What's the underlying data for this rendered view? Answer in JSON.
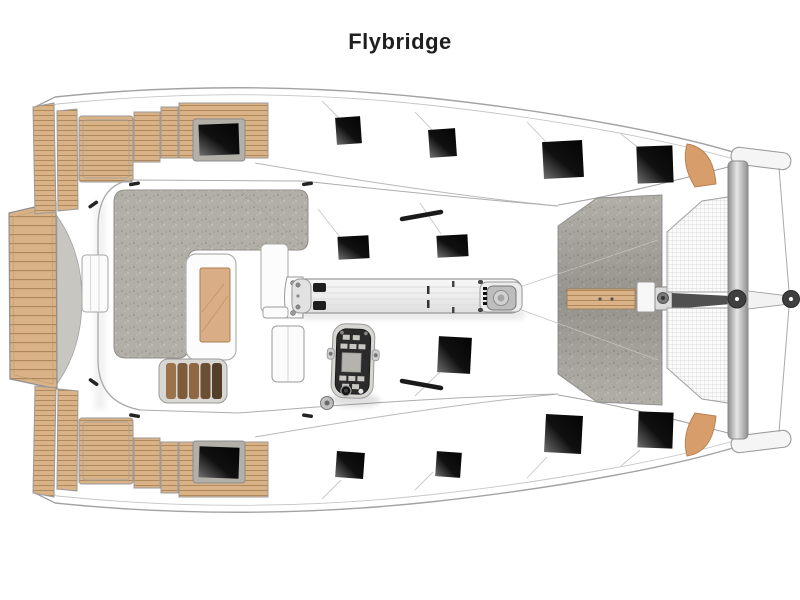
{
  "page": {
    "title_label": "Flybridge",
    "background": "#ffffff"
  },
  "diagram": {
    "type": "deck-plan",
    "subject": "catamaran flybridge level, top view, bow to the right",
    "areas": [
      {
        "name": "stern-platform",
        "surface": "teak"
      },
      {
        "name": "aft-cockpit-port",
        "surface": "teak"
      },
      {
        "name": "aft-cockpit-starboard",
        "surface": "teak"
      },
      {
        "name": "flybridge-sunpad",
        "surface": "gray-upholstery"
      },
      {
        "name": "flybridge-table",
        "surface": "wood"
      },
      {
        "name": "slatted-bench",
        "surface": "wood"
      },
      {
        "name": "helm-console",
        "surface": "dark-panel"
      },
      {
        "name": "boom",
        "surface": "aluminium"
      },
      {
        "name": "foredeck",
        "surface": "gray-nonskid"
      },
      {
        "name": "trampoline-top",
        "surface": "net"
      },
      {
        "name": "trampoline-bottom",
        "surface": "net"
      },
      {
        "name": "forward-crossbeam",
        "surface": "aluminium"
      },
      {
        "name": "bowsprit",
        "surface": "aluminium"
      },
      {
        "name": "bow-seat-port",
        "surface": "cushion"
      },
      {
        "name": "bow-seat-starboard",
        "surface": "cushion"
      }
    ],
    "hatch_count": 11,
    "hull_window_count": 2
  },
  "colors": {
    "title": "#1f1f1f",
    "outline": "#a3a3a3",
    "line_light": "#c6c6c6",
    "teak": "#d9b287",
    "teak_line": "#ab8455",
    "teak_frame": "#9a9a9a",
    "upholstery": "#b2afa8",
    "upholstery_dot": "#9d9a92",
    "transom": "#c8c6c1",
    "hatch": "#050505",
    "hatch_hl": "#6e6e6e",
    "net_line": "#cfcfcf",
    "beam": "#8e8e8e",
    "beam_hl": "#e6e6e6",
    "orange": "#d79e6b",
    "console": "#2b2b2b",
    "console_btn": "#c9c7c2",
    "table": "#d9ad85",
    "table_line": "#c49468",
    "bench_a": "#9a734c",
    "bench_b": "#6b4f33",
    "steel": "#4f4f4f"
  }
}
